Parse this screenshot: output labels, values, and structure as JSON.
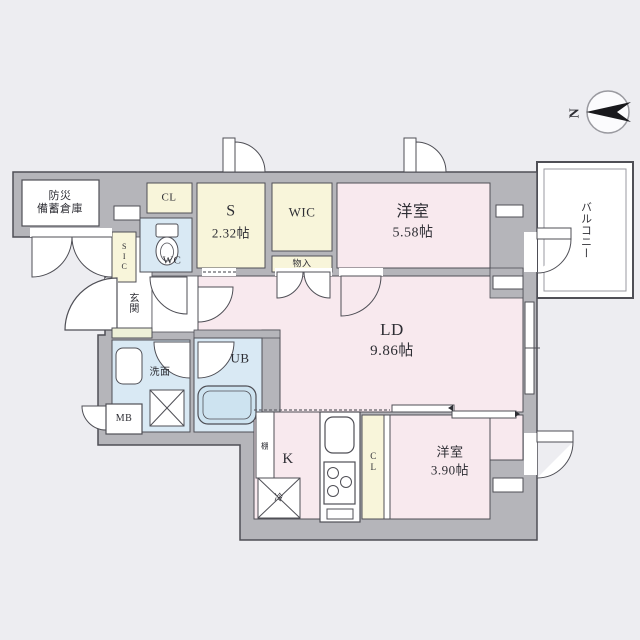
{
  "diagram_type": "japanese-apartment-floor-plan",
  "compass": {
    "north_label": "N"
  },
  "rooms": {
    "disaster_storage": {
      "line1": "防災",
      "line2": "備蓄倉庫"
    },
    "closet_top": {
      "label": "CL"
    },
    "service_room": {
      "label": "S",
      "size": "2.32帖"
    },
    "walk_in_closet": {
      "label": "WIC"
    },
    "storage_cabinet": {
      "label": "物入"
    },
    "bedroom_1": {
      "label": "洋室",
      "size": "5.58帖"
    },
    "balcony": {
      "label": "バルコニー"
    },
    "living_dining": {
      "label": "LD",
      "size": "9.86帖"
    },
    "entrance": {
      "label": "玄関"
    },
    "shoe_closet": {
      "label": "SIC"
    },
    "toilet": {
      "label": "WC"
    },
    "washroom": {
      "label": "洗面"
    },
    "unit_bath": {
      "label": "UB"
    },
    "meter_box": {
      "label": "MB"
    },
    "kitchen": {
      "label": "K"
    },
    "refrigerator": {
      "label": "冷"
    },
    "shelf": {
      "label": "棚"
    },
    "closet_bottom": {
      "label": "CL"
    },
    "bedroom_2": {
      "label": "洋室",
      "size": "3.90帖"
    }
  },
  "colors": {
    "background": "#ededf1",
    "wall_fill": "#b5b5ba",
    "line": "#4f4f56",
    "room_pink": "#f8e9ee",
    "closet_yellow": "#f8f5da",
    "wet_area_blue": "#d9e9f4",
    "tub_blue": "#cde3f0",
    "step_bar": "#eef0d8",
    "white": "#ffffff"
  }
}
